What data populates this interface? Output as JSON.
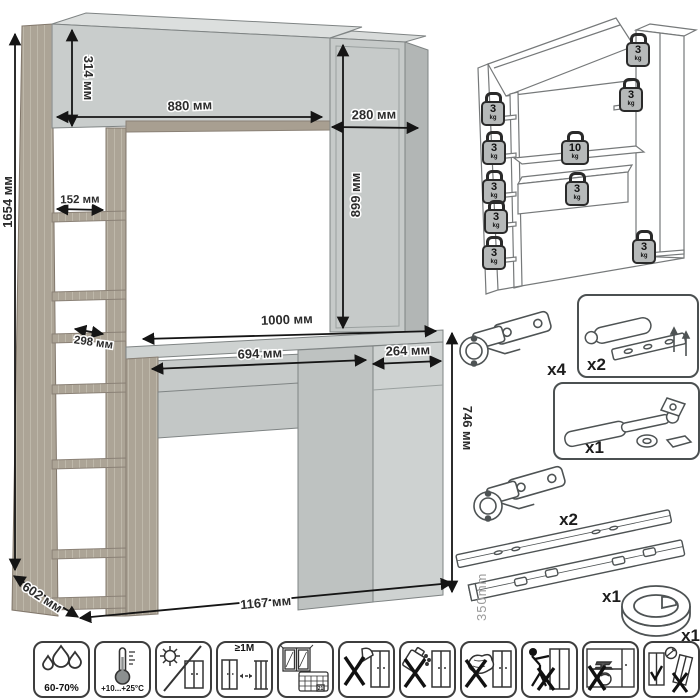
{
  "colors": {
    "wood": "#b2aa9c",
    "panel": "#c9cdcc",
    "panel_dark": "#b2b6b5",
    "panel_light": "#dcdfde",
    "outline": "#85898a",
    "dimension_text": "#2c2c2c"
  },
  "main_drawing": {
    "dimensions": {
      "total_height": "1654 мм",
      "hutch_height": "314 мм",
      "hutch_width": "880 мм",
      "top_cabinet_width": "280 мм",
      "top_cabinet_height": "899 мм",
      "shelf_depth_upper": "152 мм",
      "shelf_depth_lower": "298 мм",
      "desktop_width": "1000 мм",
      "drawer_width": "694 мм",
      "door_width": "264 мм",
      "desk_height": "746 мм",
      "depth": "602 мм",
      "total_width": "1167 мм"
    }
  },
  "load_diagram": {
    "weights": [
      {
        "value": "3",
        "unit": "kg"
      },
      {
        "value": "3",
        "unit": "kg"
      },
      {
        "value": "3",
        "unit": "kg"
      },
      {
        "value": "3",
        "unit": "kg"
      },
      {
        "value": "10",
        "unit": "kg"
      },
      {
        "value": "3",
        "unit": "kg"
      },
      {
        "value": "3",
        "unit": "kg"
      },
      {
        "value": "3",
        "unit": "kg"
      },
      {
        "value": "3",
        "unit": "kg"
      },
      {
        "value": "3",
        "unit": "kg"
      }
    ]
  },
  "hardware": {
    "items": [
      {
        "name": "concealed-hinge",
        "qty": "x4"
      },
      {
        "name": "door-damper",
        "qty": "x2"
      },
      {
        "name": "gas-lift",
        "qty": "x1"
      },
      {
        "name": "concealed-hinge",
        "qty": "x2"
      },
      {
        "name": "drawer-slides",
        "qty": "x1",
        "length": "350mm"
      },
      {
        "name": "cable-grommet",
        "qty": "x1"
      }
    ]
  },
  "care_icons": {
    "items": [
      {
        "name": "humidity",
        "label": "60-70%"
      },
      {
        "name": "temperature",
        "label": "+10...+25°C"
      },
      {
        "name": "no-direct-sunlight",
        "label": ""
      },
      {
        "name": "keep-distance-from-heat",
        "label": "≥1M"
      },
      {
        "name": "ventilate-room",
        "label": "21"
      },
      {
        "name": "no-sharp-tools",
        "label": ""
      },
      {
        "name": "no-aggressive-liquids",
        "label": ""
      },
      {
        "name": "no-abrasive-cleaning",
        "label": ""
      },
      {
        "name": "no-dragging",
        "label": ""
      },
      {
        "name": "no-overloading",
        "label": ""
      },
      {
        "name": "anchor-to-wall",
        "label": ""
      }
    ]
  }
}
